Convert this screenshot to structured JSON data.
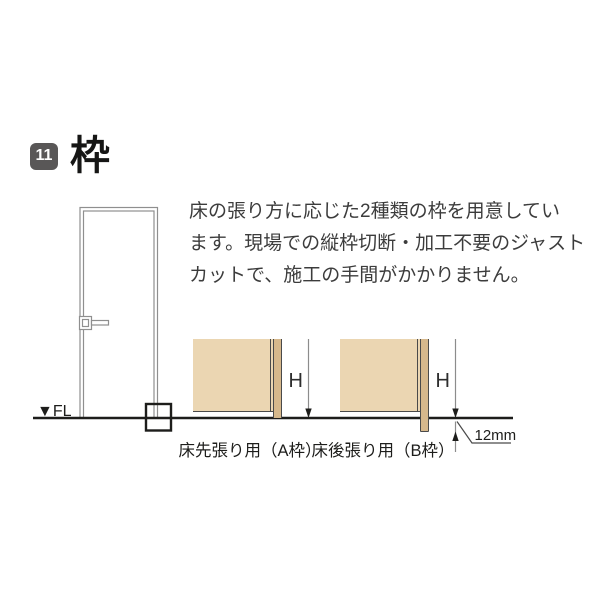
{
  "header": {
    "section_number": "11",
    "title": "枠"
  },
  "description": {
    "lines": [
      "床の張り方に応じた2種類の枠を用意してい",
      "ます。現場での縦枠切断・加工不要のジャスト",
      "カットで、施工の手間がかかりません。"
    ]
  },
  "figure": {
    "floor_level_label": "▼FL",
    "detail_a": {
      "label": "床先張り用（A枠）",
      "height_label": "H"
    },
    "detail_b": {
      "label": "床後張り用（B枠）",
      "height_label": "H",
      "floor_offset_label": "12mm"
    }
  },
  "colors": {
    "wall_fill": "#ebd6b2",
    "frame_fill": "#d6b88c",
    "ink": "#1d1d1b",
    "diagram_edge": "#4a4a4a",
    "dimension_gray": "#8c8c8c",
    "door_gray": "#8f8f8f",
    "badge_background": "#595757"
  }
}
